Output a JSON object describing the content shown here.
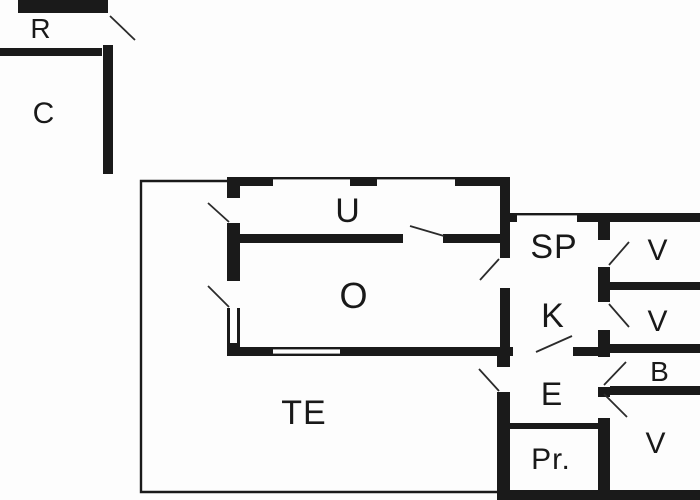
{
  "plan": {
    "type": "floor-plan",
    "colors": {
      "wall": "#1a1a1a",
      "background": "#fdfdfd",
      "door_swing": "#2b2b2b"
    },
    "rooms": {
      "r": {
        "label": "R"
      },
      "c": {
        "label": "C"
      },
      "u": {
        "label": "U"
      },
      "o": {
        "label": "O"
      },
      "te": {
        "label": "TE"
      },
      "sp": {
        "label": "SP"
      },
      "k": {
        "label": "K"
      },
      "e": {
        "label": "E"
      },
      "pr": {
        "label": "Pr."
      },
      "v1": {
        "label": "V"
      },
      "v2": {
        "label": "V"
      },
      "b": {
        "label": "B"
      },
      "v3": {
        "label": "V"
      }
    }
  }
}
